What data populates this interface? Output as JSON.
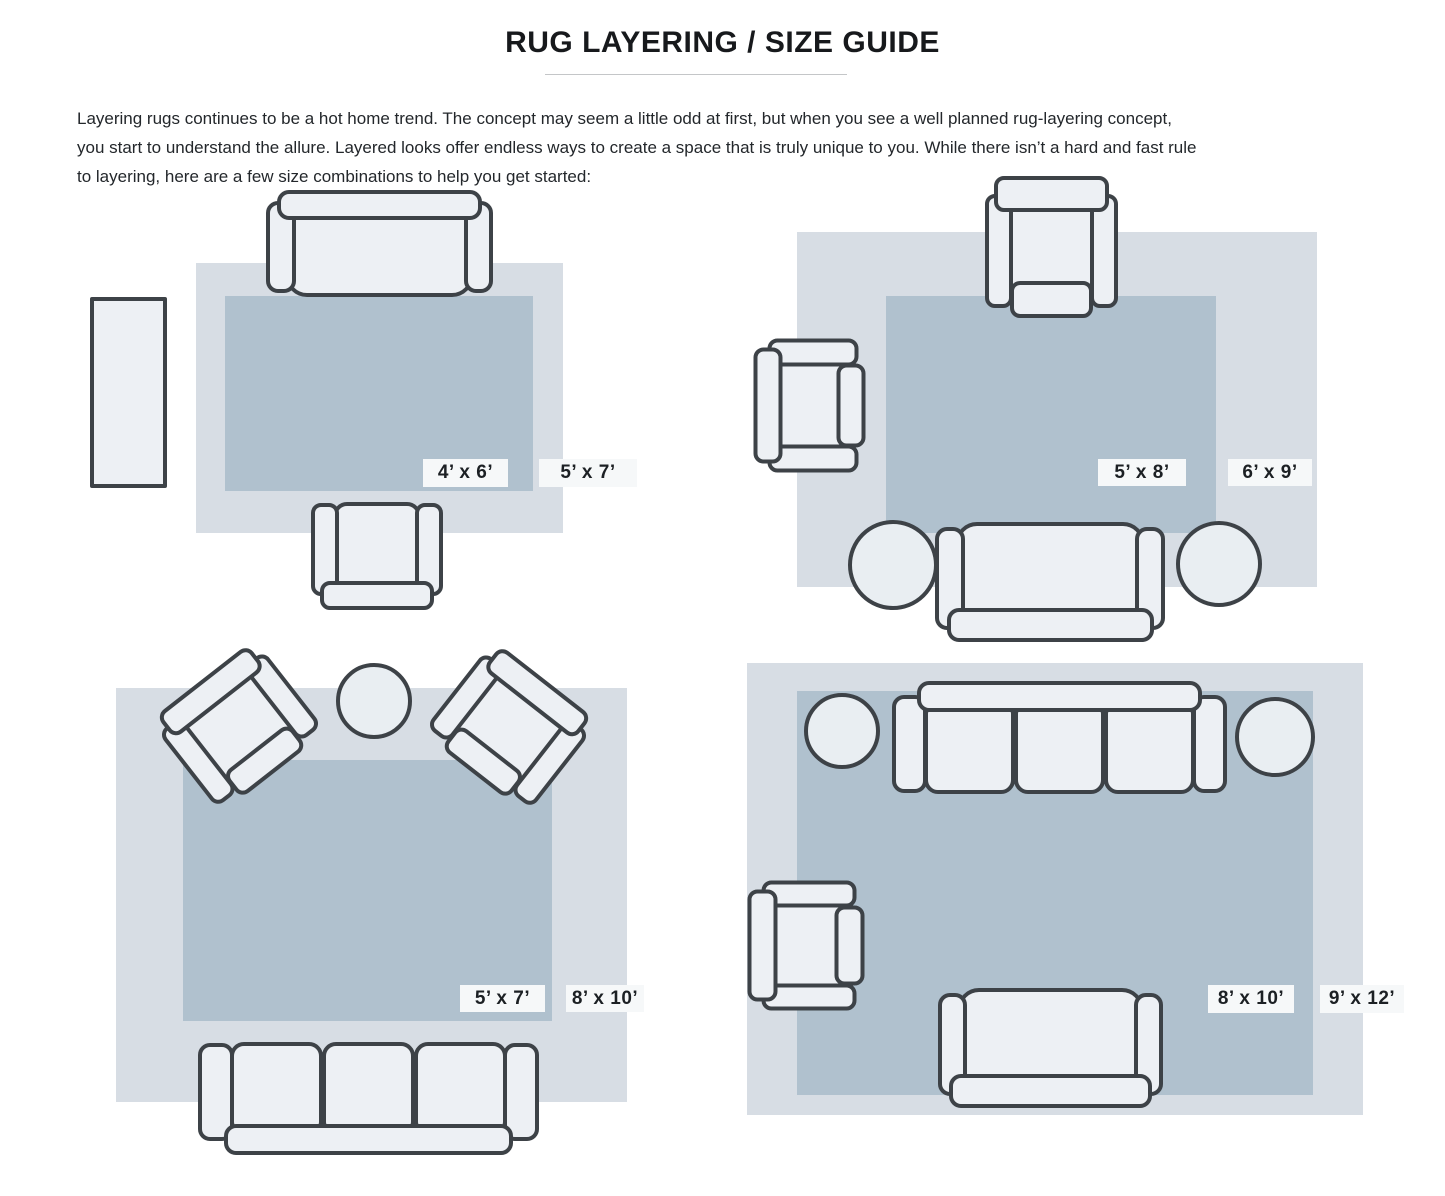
{
  "title": "RUG LAYERING / SIZE GUIDE",
  "intro_lines": [
    "Layering rugs continues to be a hot home trend. The concept may seem a little odd at first, but when you see a well planned rug-layering concept,",
    "you start to understand the allure. Layered looks offer endless ways to create a space that is truly unique to you. While there isn’t a hard and fast rule",
    "to layering, here are a few size combinations to help you get started:"
  ],
  "diagrams": [
    {
      "position": "top-left",
      "furniture": [
        "sofa",
        "side-table",
        "armchair"
      ],
      "inner_rug_label": "4’ x 6’",
      "outer_rug_label": "5’ x 7’"
    },
    {
      "position": "top-right",
      "furniture": [
        "armchair",
        "armchair",
        "sofa",
        "pouf",
        "pouf"
      ],
      "inner_rug_label": "5’ x 8’",
      "outer_rug_label": "6’ x 9’"
    },
    {
      "position": "bottom-left",
      "furniture": [
        "armchair",
        "armchair",
        "round-table",
        "sofa"
      ],
      "inner_rug_label": "5’ x 7’",
      "outer_rug_label": "8’ x 10’"
    },
    {
      "position": "bottom-right",
      "furniture": [
        "sofa",
        "round-table",
        "round-table",
        "armchair",
        "loveseat"
      ],
      "inner_rug_label": "8’ x 10’",
      "outer_rug_label": "9’ x 12’"
    }
  ],
  "colors": {
    "outer_rug": "#d7dde4",
    "inner_rug": "#b0c1ce",
    "furniture_fill": "#edf0f4",
    "outline": "#3d4247"
  }
}
